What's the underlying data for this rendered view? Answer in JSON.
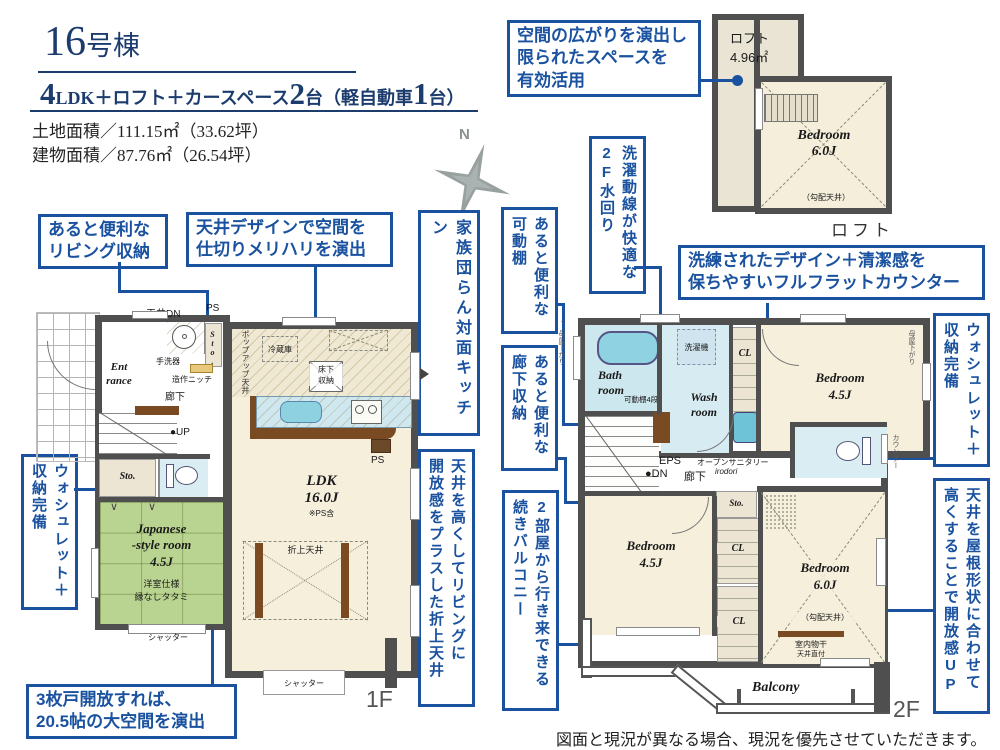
{
  "colors": {
    "accent_blue": "#1a52a0",
    "title_navy": "#1c3c6e",
    "wall_gray": "#4f4f4f",
    "room_cream": "#f5efdc",
    "tatami_green": "#b9d490",
    "water_blue": "#cde7ef",
    "storage_beige": "#ece5d3"
  },
  "header": {
    "title_number": "16",
    "title_suffix": "号棟",
    "spec": {
      "n1": "4",
      "t1": "LDK＋ロフト＋カースペース",
      "n2": "2",
      "t2": "台（軽自動車",
      "n3": "1",
      "t3": "台）"
    },
    "land_area": "土地面積／111.15㎡（33.62坪）",
    "building_area": "建物面積／87.76㎡（26.54坪）"
  },
  "compass": {
    "north": "N"
  },
  "callouts": {
    "living_storage": {
      "l1": "あると便利な",
      "l2": "リビング収納"
    },
    "ceiling_design": {
      "l1": "天井デザインで空間を",
      "l2": "仕切りメリハリを演出"
    },
    "kitchen": {
      "c1": "家族団らん対面キッチン"
    },
    "loft_space": {
      "l1": "空間の広がりを演出し",
      "l2": "限られたスペースを",
      "l3": "有効活用"
    },
    "laundry": {
      "c1": "洗濯動線が快適な",
      "c2": "2F水回り"
    },
    "shelf": {
      "c1": "あると便利な",
      "c2": "可動棚"
    },
    "hall_storage": {
      "c1": "あると便利な",
      "c2": "廊下収納"
    },
    "twin_balcony": {
      "c1": "2部屋から行き来できる",
      "c2": "続きバルコニー"
    },
    "coffered": {
      "c1": "天井を高くしてリビングに",
      "c2": "開放感をプラスした折上天井"
    },
    "washlet1": {
      "c1": "ウォシュレット＋",
      "c2": "収納完備"
    },
    "doors": {
      "l1": "3枚戸開放すれば、",
      "l2": "20.5帖の大空間を演出"
    },
    "counter": {
      "l1": "洗練されたデザイン＋清潔感を",
      "l2": "保ちやすいフルフラットカウンター"
    },
    "washlet2": {
      "c1": "ウォシュレット＋",
      "c2": "収納完備"
    },
    "roof": {
      "c1": "天井を屋根形状に合わせて",
      "c2": "高くすることで開放感UP"
    }
  },
  "loft": {
    "area_l1": "ロフト",
    "area_l2": "4.96㎡",
    "bedroom_l1": "Bedroom",
    "bedroom_l2": "6.0J",
    "slope": "（勾配天井）",
    "label": "ロフト"
  },
  "floor1": {
    "label": "1F",
    "ceiling_dn": "天井DN",
    "ps_top": "PS",
    "wash_basin": "手洗器",
    "niche": "造作ニッチ",
    "sto": "Sto.",
    "entrance_l1": "Ent",
    "entrance_l2": "rance",
    "hall": "廊下",
    "up": "●UP",
    "door_mark": "∨",
    "jp_l1": "Japanese",
    "jp_l2": "-style room",
    "jp_l3": "4.5J",
    "jp_l4": "洋室仕様",
    "jp_l5": "縁なしタタミ",
    "shutter": "シャッター",
    "fridge": "冷蔵庫",
    "underfloor_l1": "床下",
    "underfloor_l2": "収納",
    "popup": "ポップアップ天井",
    "ps_bottom": "PS",
    "ldk_l1": "LDK",
    "ldk_l2": "16.0J",
    "ldk_l3": "※PS含",
    "coffered": "折上天井"
  },
  "floor2": {
    "label": "2F",
    "moya": "母屋下がり",
    "arrow": "↑",
    "bath_l1": "Bath",
    "bath_l2": "room",
    "shelf4": "可動棚4段",
    "washer": "洗濯機",
    "wash_l1": "Wash",
    "wash_l2": "room",
    "cl": "CL",
    "bed45_l1": "Bedroom",
    "bed45_l2": "4.5J",
    "eps": "EPS",
    "dn": "●DN",
    "hall": "廊下",
    "open_sanitary_l1": "オープンサニタリー",
    "open_sanitary_l2": "irodori",
    "sto": "Sto.",
    "counter_label": "カウンター",
    "bed60_l1": "Bedroom",
    "bed60_l2": "6.0J",
    "slope": "（勾配天井）",
    "drying_l1": "室内物干",
    "drying_l2": "天井直付",
    "balcony": "Balcony"
  },
  "footer": {
    "disclaimer": "図面と現況が異なる場合、現況を優先させていただきます。"
  }
}
